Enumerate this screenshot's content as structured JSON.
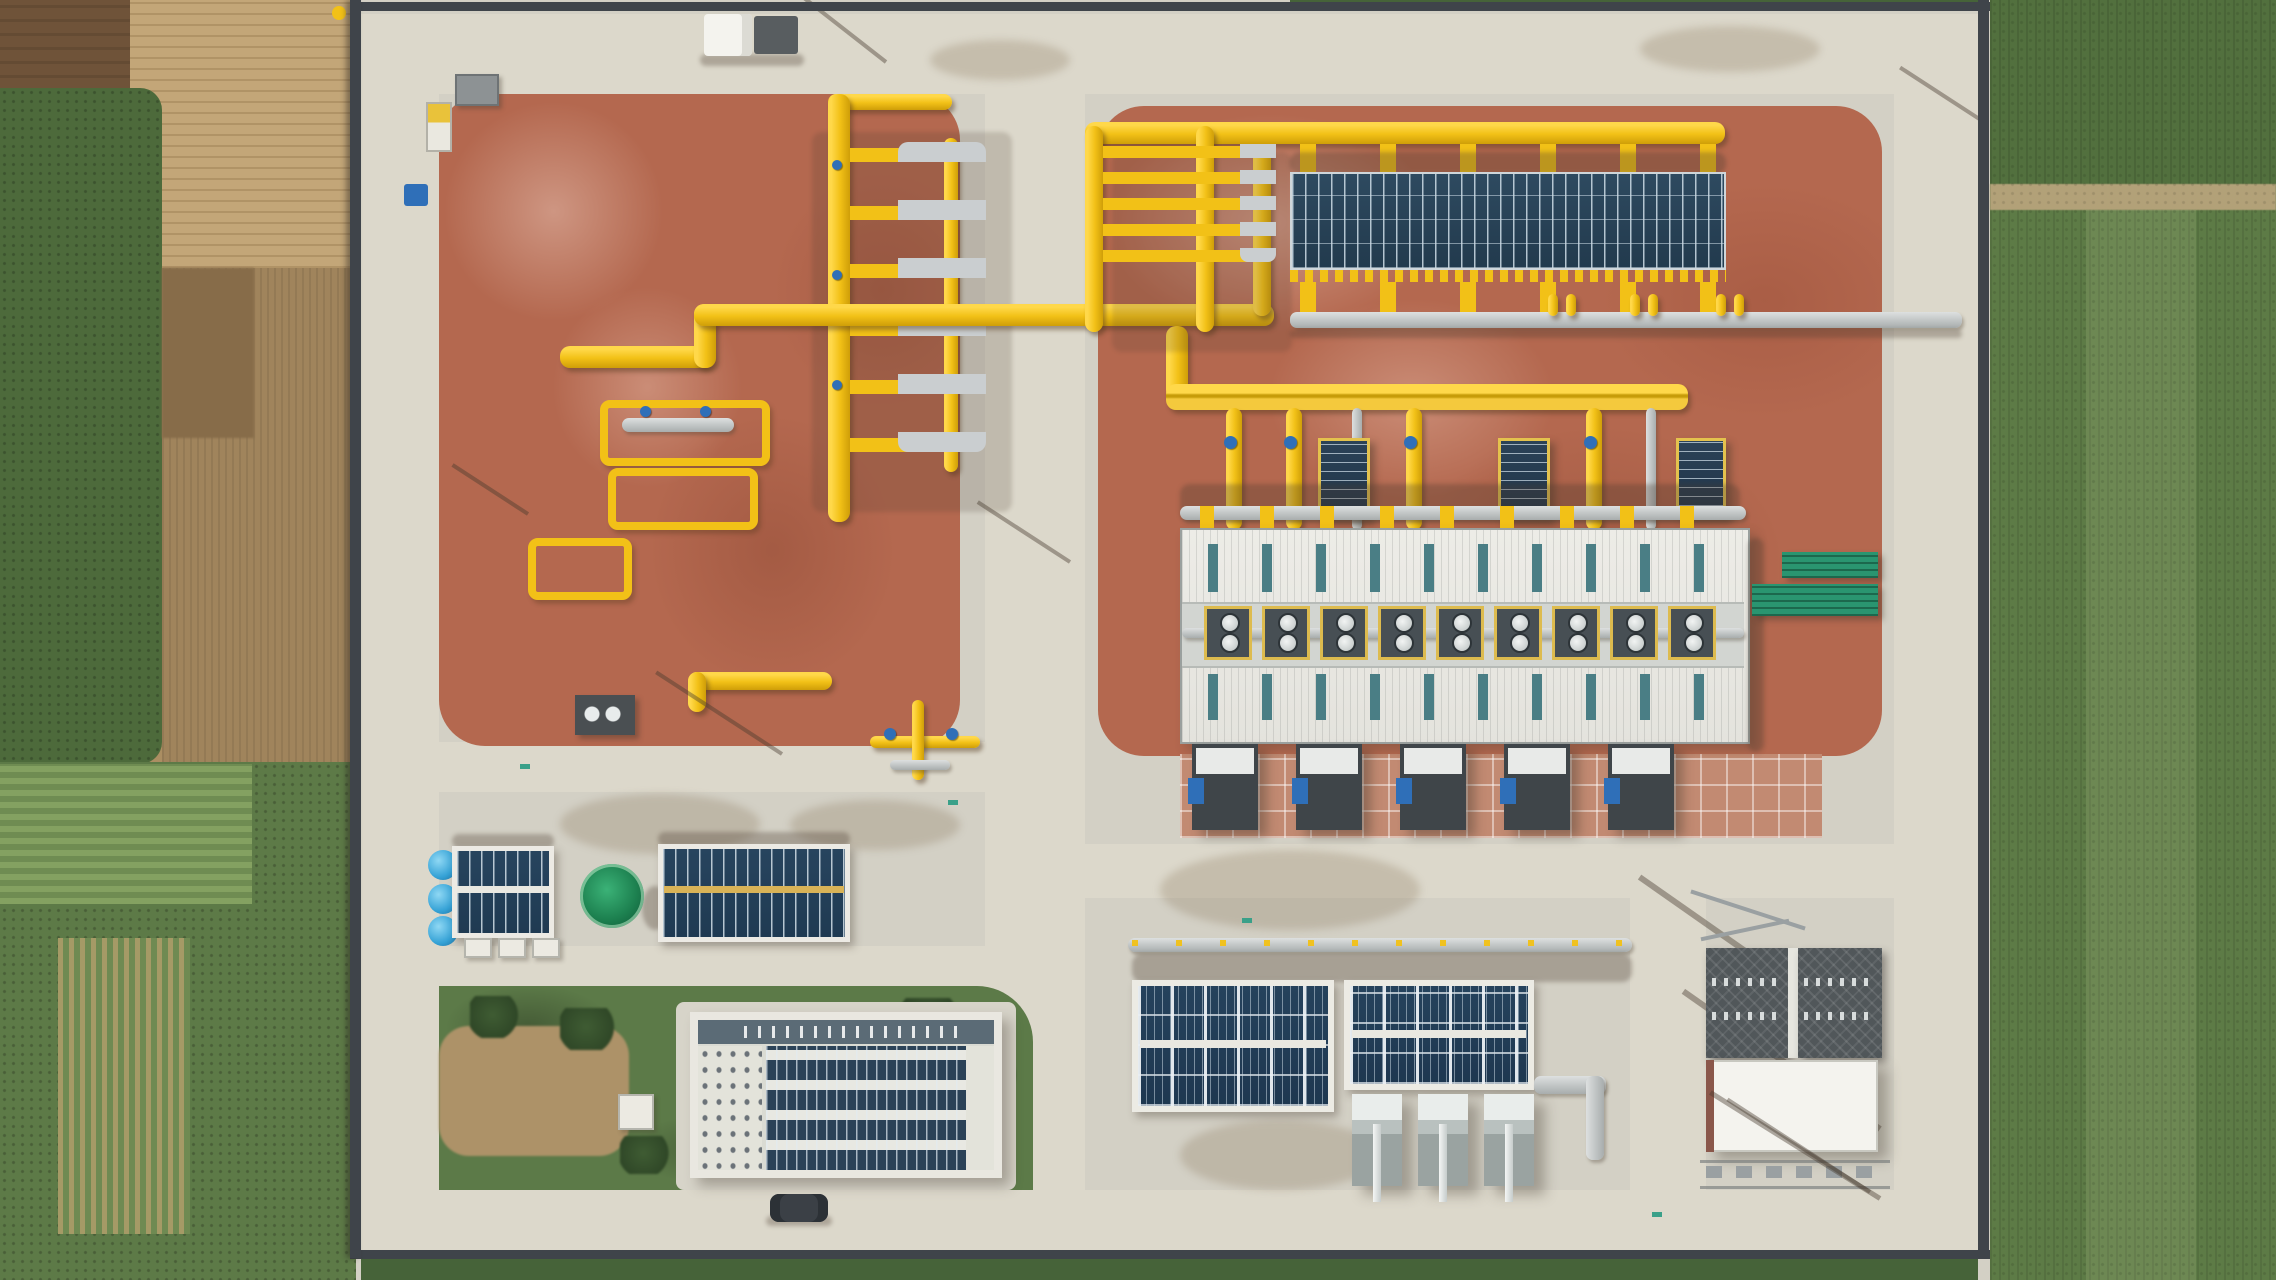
{
  "scene": {
    "type": "aerial-drone-photograph",
    "subject": "natural-gas compressor / storage station under construction",
    "surroundings": "farm fields (green crops and brown tilled soil) on west and east sides",
    "facility": {
      "ground": "light concrete aprons and roads with two large red-brown gravel pads",
      "pipework_color": "yellow",
      "solar_canopy_top_right": {
        "panel_rows": 4,
        "support_stubs": 6
      },
      "pipe_manifolds": {
        "left_rows": 6,
        "right_rows": 5
      },
      "process_building": {
        "vent_units": 9,
        "skylight_strips_per_row": 10,
        "roof": "white ribbed metal"
      },
      "cooler_skids_below_building": 5,
      "storage": {
        "green_sphere_tanks": 1,
        "blue_horizontal_tanks": 3
      },
      "solar_roof_buildings": 5,
      "compressor_units": 3,
      "substation": {
        "transformer_bays": 2,
        "white_control_building": 1
      },
      "vehicles": {
        "white_truck": 1,
        "dark_car": 1
      }
    }
  },
  "palette": {
    "concrete": "#d3d0c5",
    "road": "#dcd8cb",
    "red_gravel": "#b4684f",
    "pipe_yellow": "#f2c117",
    "solar_dark": "#2b4257",
    "roof_white": "#eceae5",
    "skylight_teal": "#4a7e85",
    "grass": "#5c7a48",
    "crop_green": "#5d7b46",
    "soil_brown": "#6f5339",
    "soil_tan": "#c3a678",
    "hedge": "#466339",
    "wall_dark": "#3f444a",
    "steel_gray": "#b8bcbc",
    "tank_green": "#1d8150",
    "tank_blue": "#35a2d6",
    "valve_blue": "#2f6fb8",
    "cooler_teal": "#2a9570"
  }
}
